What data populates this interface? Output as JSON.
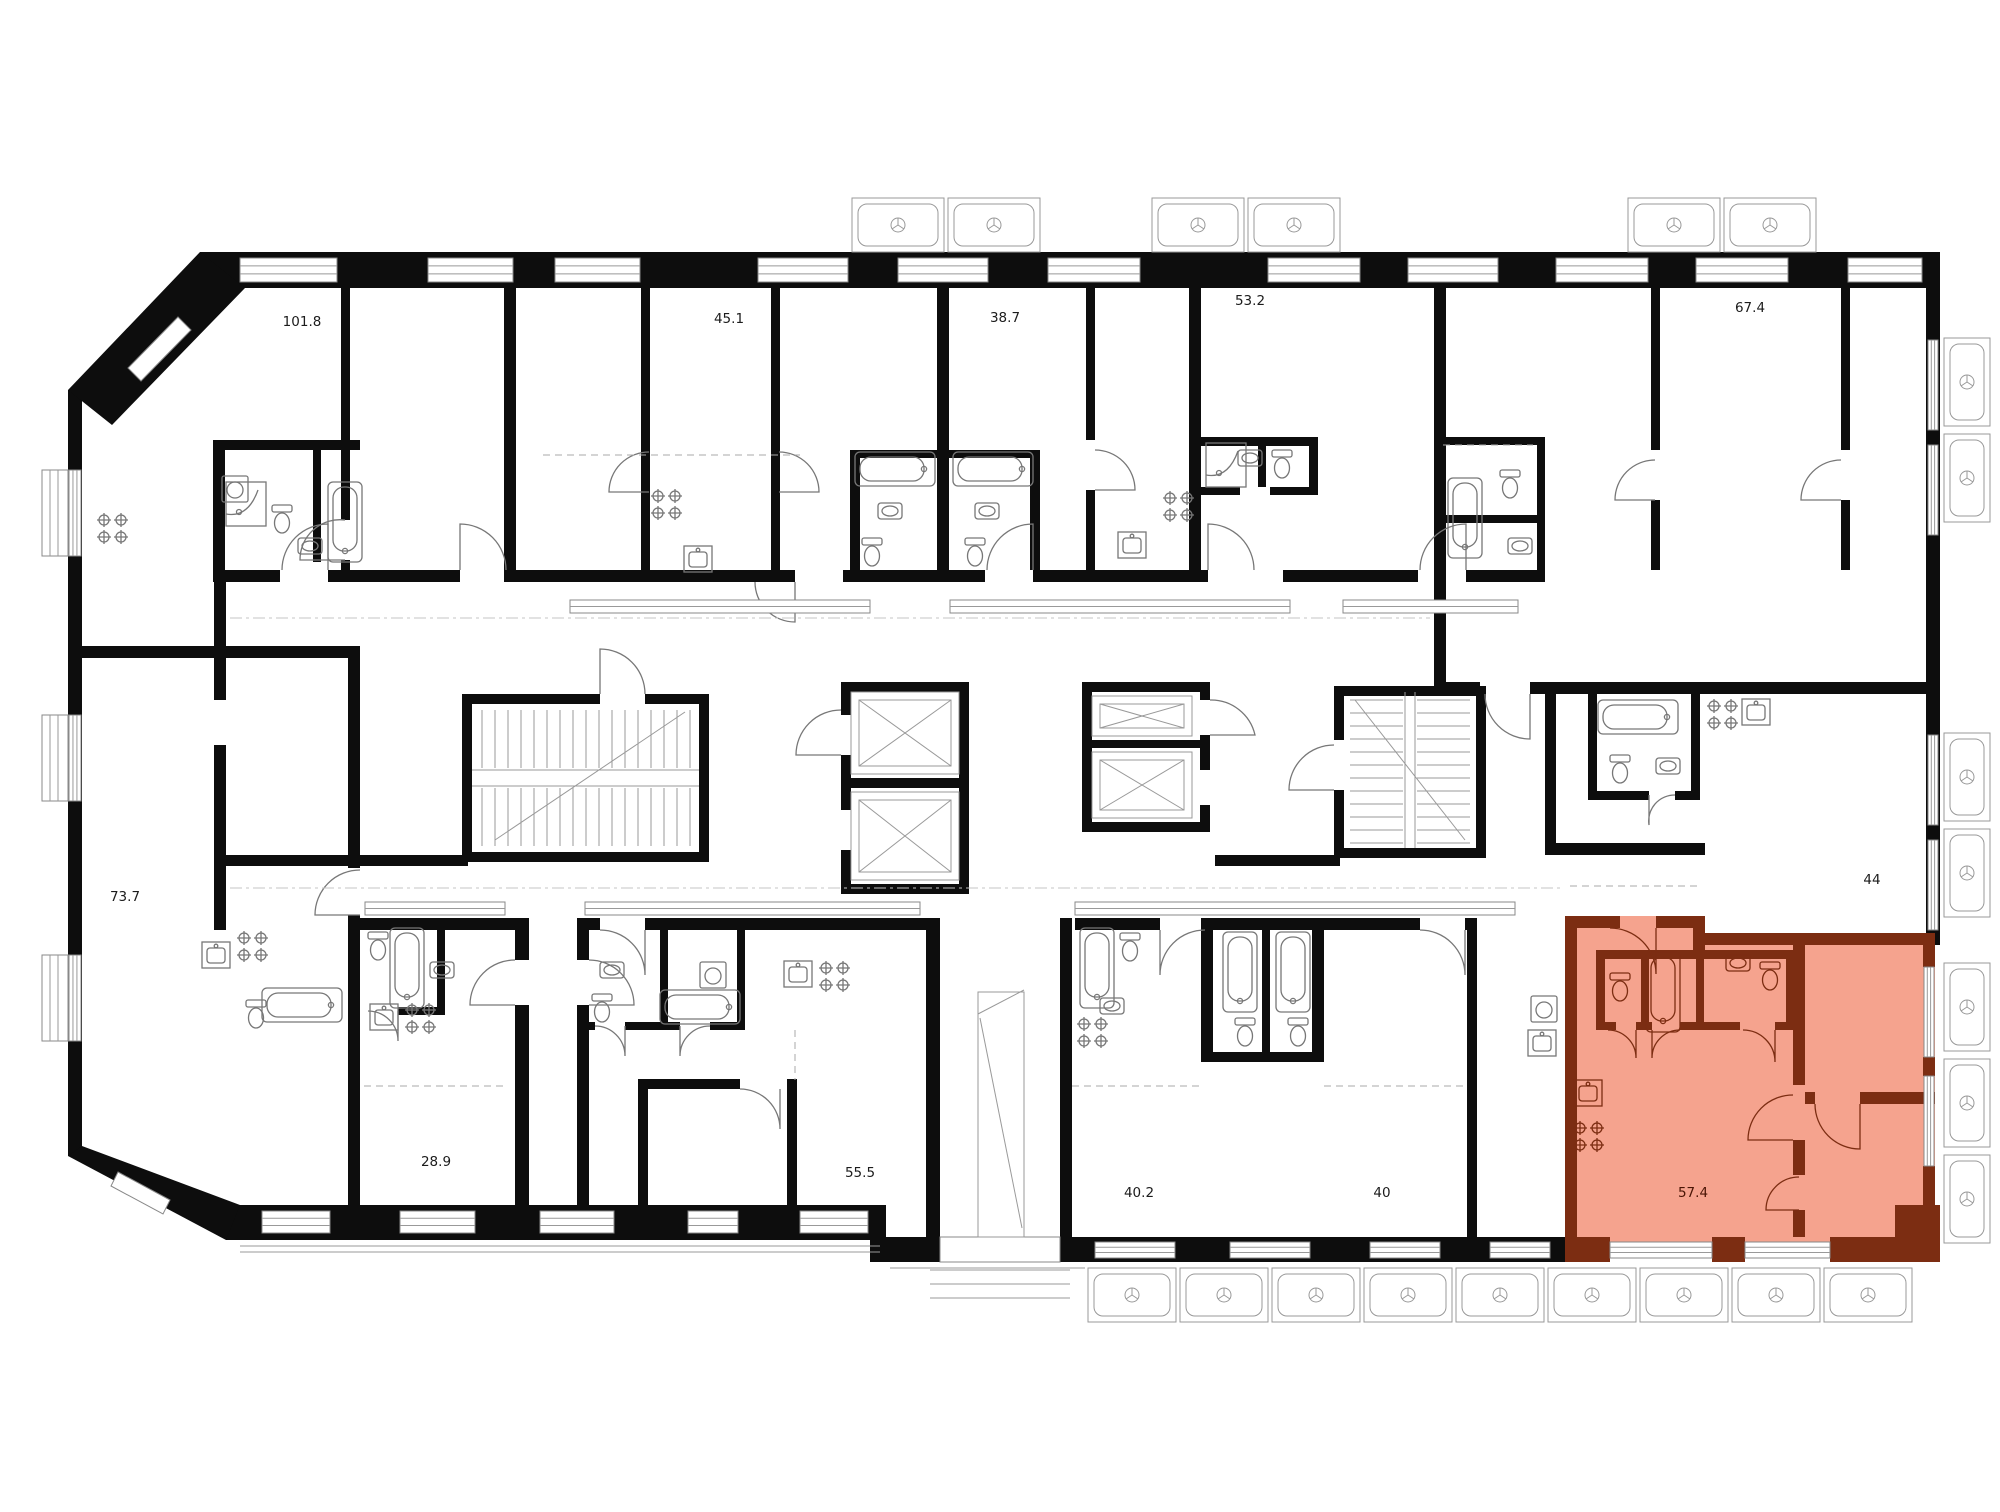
{
  "plan": {
    "units": [
      {
        "id": "apt-101-8",
        "area": "101.8",
        "label_x": 302,
        "label_y": 326,
        "highlighted": false
      },
      {
        "id": "apt-45-1",
        "area": "45.1",
        "label_x": 729,
        "label_y": 323,
        "highlighted": false
      },
      {
        "id": "apt-38-7",
        "area": "38.7",
        "label_x": 1005,
        "label_y": 322,
        "highlighted": false
      },
      {
        "id": "apt-53-2",
        "area": "53.2",
        "label_x": 1250,
        "label_y": 305,
        "highlighted": false
      },
      {
        "id": "apt-67-4",
        "area": "67.4",
        "label_x": 1750,
        "label_y": 312,
        "highlighted": false
      },
      {
        "id": "apt-73-7",
        "area": "73.7",
        "label_x": 125,
        "label_y": 901,
        "highlighted": false
      },
      {
        "id": "apt-44",
        "area": "44",
        "label_x": 1872,
        "label_y": 884,
        "highlighted": false
      },
      {
        "id": "apt-28-9",
        "area": "28.9",
        "label_x": 436,
        "label_y": 1166,
        "highlighted": false
      },
      {
        "id": "apt-55-5",
        "area": "55.5",
        "label_x": 860,
        "label_y": 1177,
        "highlighted": false
      },
      {
        "id": "apt-40-2",
        "area": "40.2",
        "label_x": 1139,
        "label_y": 1197,
        "highlighted": false
      },
      {
        "id": "apt-40",
        "area": "40",
        "label_x": 1382,
        "label_y": 1197,
        "highlighted": false
      },
      {
        "id": "apt-57-4",
        "area": "57.4",
        "label_x": 1693,
        "label_y": 1197,
        "highlighted": true
      }
    ],
    "colors": {
      "background": "#ffffff",
      "wall": "#0d0d0d",
      "highlight_fill": "#f5a38e",
      "highlight_wall": "#7c2d12",
      "label_text": "#1c1c1c",
      "highlight_label_text": "#4a1505"
    }
  }
}
